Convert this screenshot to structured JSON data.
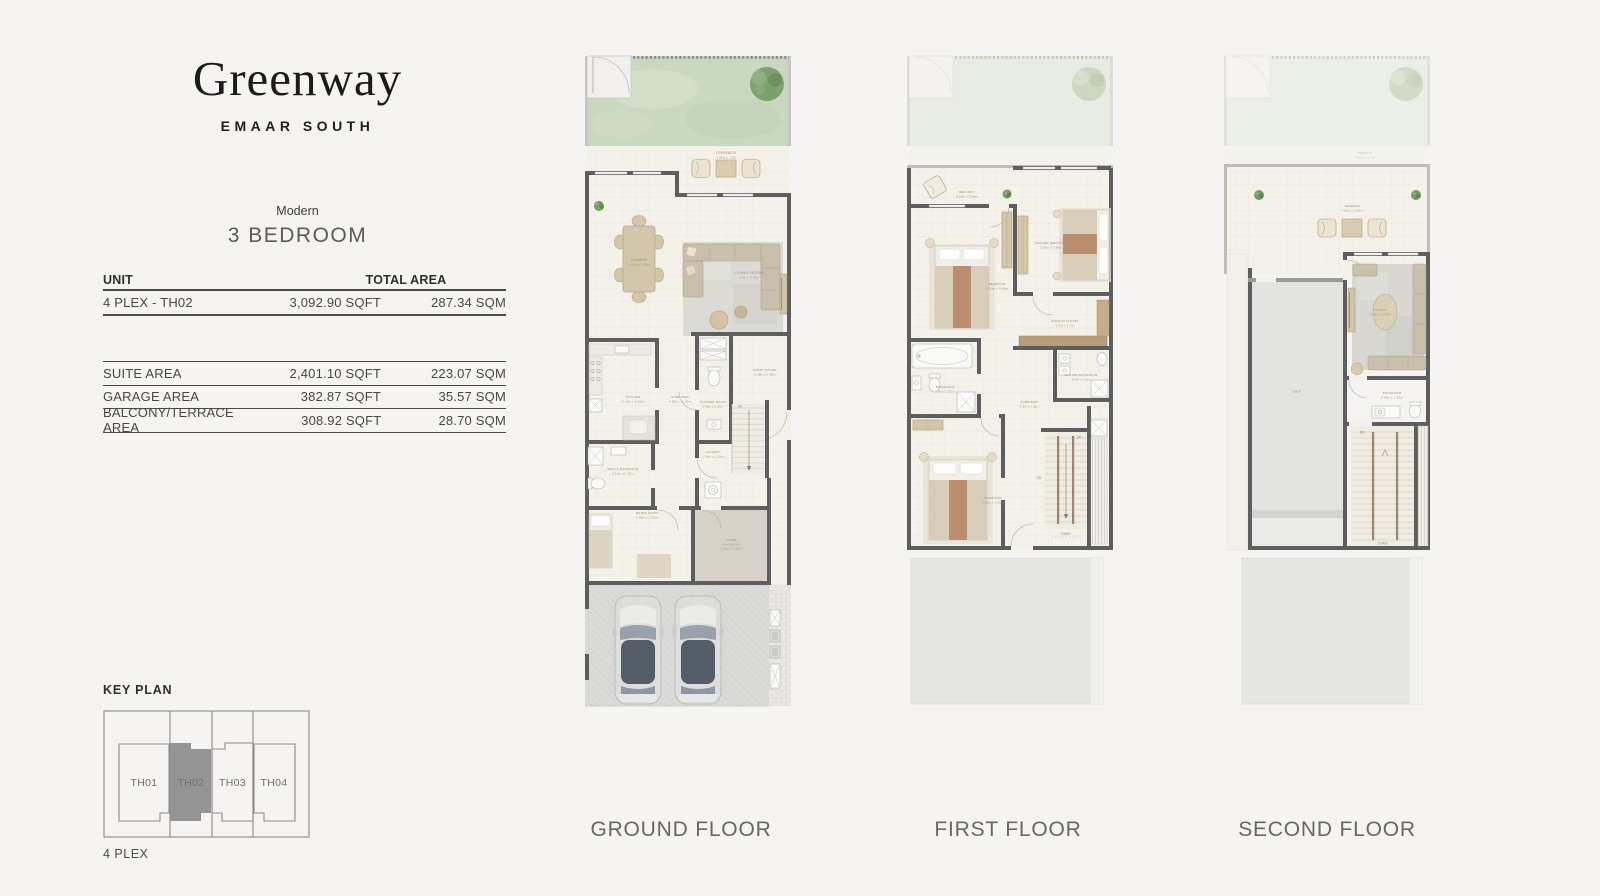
{
  "colors": {
    "page_bg": "#f5f4f2",
    "wall": "#5e5e5e",
    "garden_green": "#cbd8c1",
    "keyplan_highlight": "#949494"
  },
  "brand": {
    "logo": "Greenway",
    "subtitle": "EMAAR SOUTH"
  },
  "unit": {
    "style": "Modern",
    "type": "3 BEDROOM"
  },
  "area_table": {
    "col_unit": "UNIT",
    "col_total_area": "TOTAL AREA",
    "unit_row": {
      "label": "4 PLEX - TH02",
      "sqft": "3,092.90 SQFT",
      "sqm": "287.34 SQM"
    },
    "rows": [
      {
        "label": "SUITE AREA",
        "sqft": "2,401.10 SQFT",
        "sqm": "223.07 SQM"
      },
      {
        "label": "GARAGE AREA",
        "sqft": "382.87 SQFT",
        "sqm": "35.57 SQM"
      },
      {
        "label": "BALCONY/TERRACE AREA",
        "sqft": "308.92 SQFT",
        "sqm": "28.70 SQM"
      }
    ]
  },
  "key_plan": {
    "title": "KEY PLAN",
    "caption": "4 PLEX",
    "units": [
      "TH01",
      "TH02",
      "TH03",
      "TH04"
    ],
    "highlighted_unit": "TH02"
  },
  "floors": {
    "ground": {
      "label": "GROUND FLOOR",
      "rooms": {
        "terrace": {
          "name": "TERRACE",
          "dims": "3.50m x 1.50"
        },
        "dining": {
          "name": "DINING",
          "dims": "4.20m x 3.30m"
        },
        "living_room": {
          "name": "LIVING ROOM",
          "dims": "5.4m x 3.30m"
        },
        "kitchen": {
          "name": "KITCHEN",
          "dims": "3.10m x 2.10m"
        },
        "corridor": {
          "name": "CORRIDOR",
          "dims": "4.80m x 1.10m"
        },
        "powder_room": {
          "name": "POWDER ROOM",
          "dims": "2.28m x 1.00m"
        },
        "entry_foyer": {
          "name": "ENTRY FOYER",
          "dims": "2.40m x 1.90m"
        },
        "laundry": {
          "name": "LAUNDRY",
          "dims": "1.50m x 1.20m"
        },
        "maids_bathroom": {
          "name": "MAID'S BATHROOM",
          "dims": "2.10m x 1.20m"
        },
        "maids_room": {
          "name": "MAID'S ROOM",
          "dims": "2.80m x 2.10m"
        },
        "store": {
          "name": "STORE",
          "sub": "W.M ROOM",
          "dims": "2.30m x 2.10m"
        },
        "stair_up": "UP"
      }
    },
    "first": {
      "label": "FIRST FLOOR",
      "rooms": {
        "balcony": {
          "name": "BALCONY",
          "dims": "3.20m x 1.60m"
        },
        "bedroom_2": {
          "name": "BEDROOM",
          "dims": "3.50m x 3.30m"
        },
        "master_bedroom": {
          "name": "MASTER BEDROOM",
          "dims": "3.80m X 3.80m"
        },
        "walk_in_closet": {
          "name": "WALK-IN CLOSET",
          "dims": "2.5m x 1.7m"
        },
        "bathroom": {
          "name": "BATHROOM",
          "dims": "2.65m x 2.0m"
        },
        "corridor": {
          "name": "CORRIDOR",
          "dims": "2.6m x 1.8m"
        },
        "master_bathroom": {
          "name": "MASTER BATHROOM",
          "dims": "2.5m x 1.6m"
        },
        "bedroom_3": {
          "name": "BEDROOM",
          "dims": "4.15m x 3.30m"
        },
        "stair": "STAIR",
        "up": "UP",
        "dn": "DN"
      }
    },
    "second": {
      "label": "SECOND FLOOR",
      "rooms": {
        "terrace": {
          "name": "TERRACE",
          "dims": "7.35m x 2.60m"
        },
        "ghost_terrace": {
          "name": "TERRACE",
          "dims": "3.50m x 1.50"
        },
        "lounge": {
          "name": "LOUNGE",
          "dims": "3.50m x 3.90m"
        },
        "mep": {
          "name": "MEP"
        },
        "bathroom": {
          "name": "BATHROOM",
          "dims": "2.60m x 1.90m"
        },
        "stair": "STAIR",
        "dn": "DN"
      }
    }
  }
}
